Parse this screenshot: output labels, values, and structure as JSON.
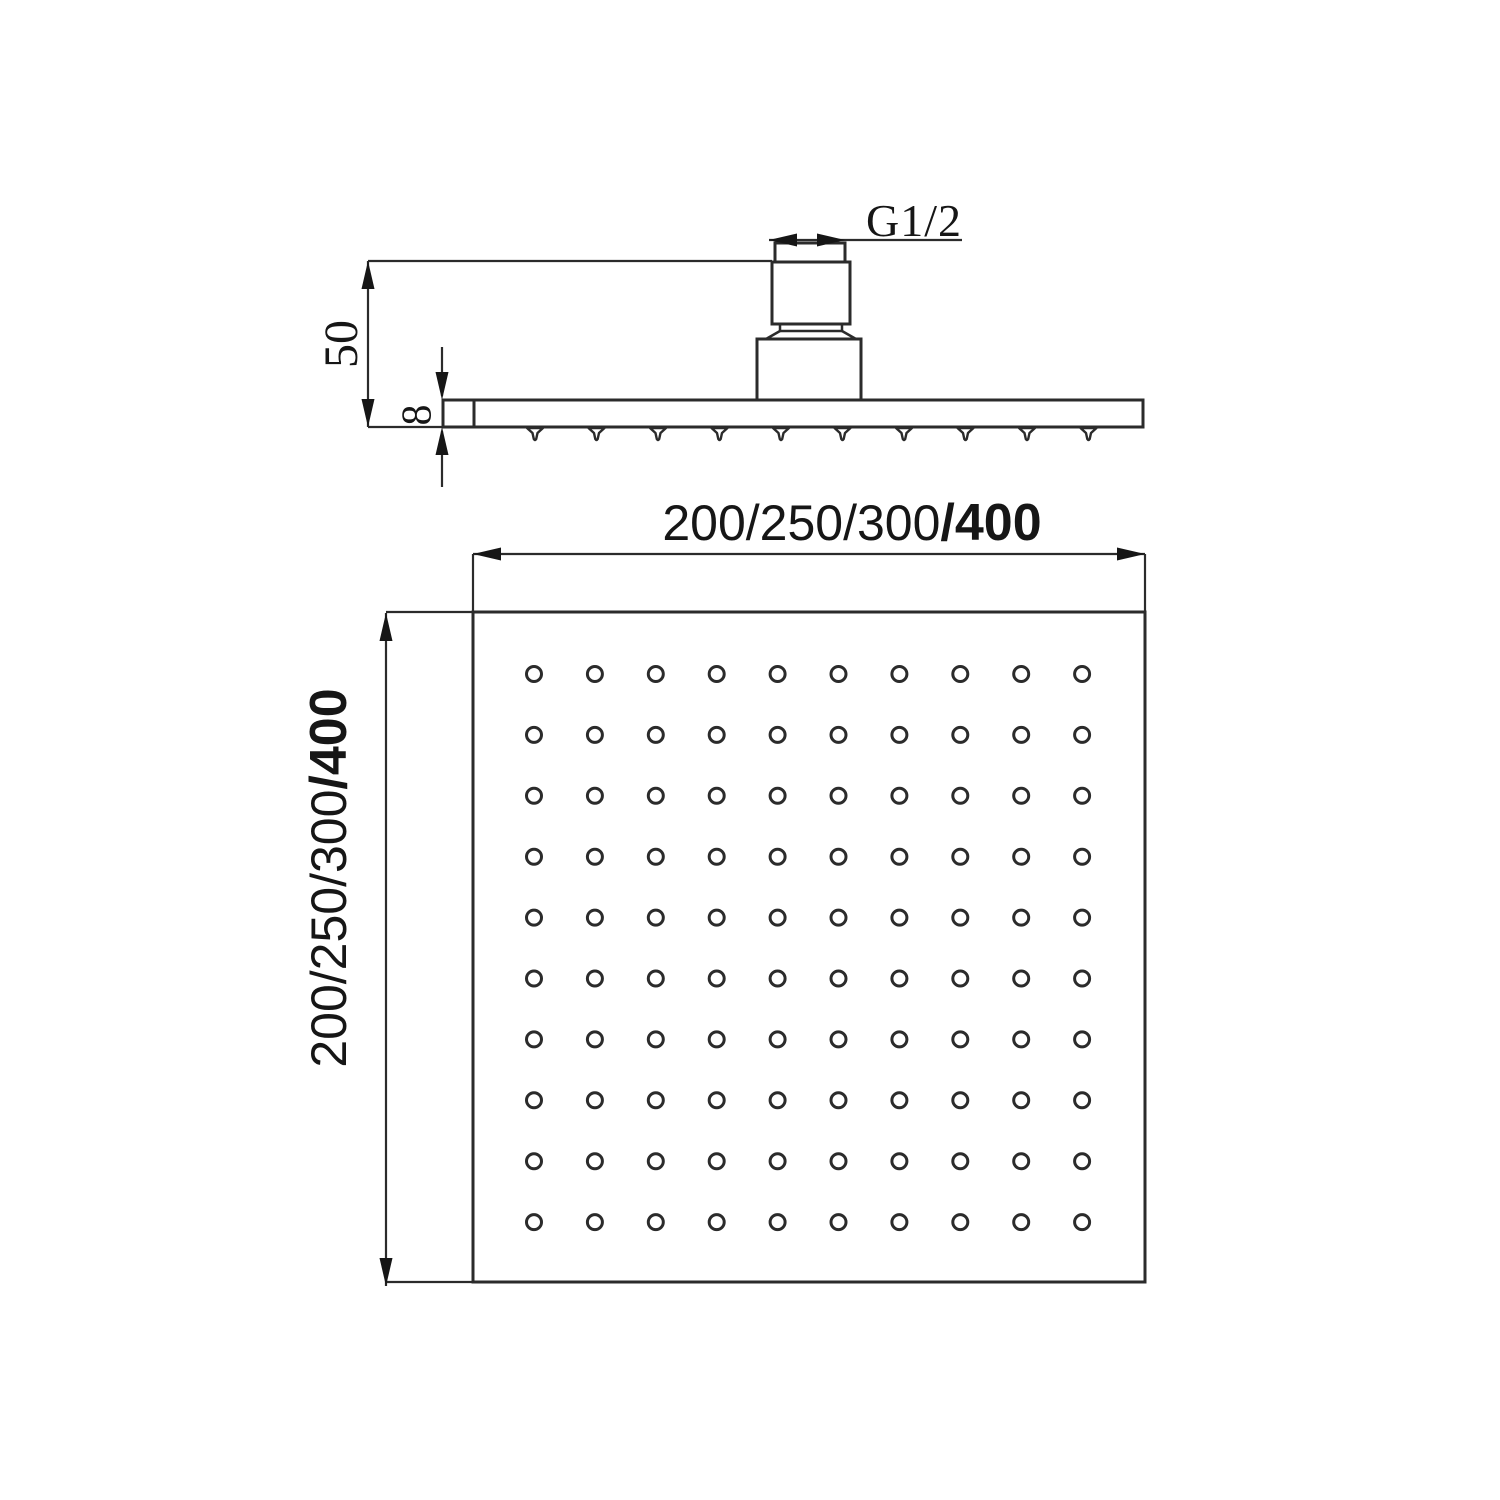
{
  "page": {
    "background": "#ffffff",
    "line_color": "#2b2b2b",
    "ink_color": "#161616",
    "description": "Technical dimension drawing of a square rainfall shower head, side elevation and plan view"
  },
  "side_view": {
    "labels": {
      "thread": "G1/2",
      "height": "50",
      "plate_thickness": "8"
    },
    "nozzle_count": 10
  },
  "plan_view": {
    "labels": {
      "width": {
        "normal": "200/250/300",
        "bold": "/400"
      },
      "height": {
        "normal": "200/250/300",
        "bold": "/400"
      }
    },
    "holes": {
      "rows": 10,
      "cols": 10
    }
  }
}
